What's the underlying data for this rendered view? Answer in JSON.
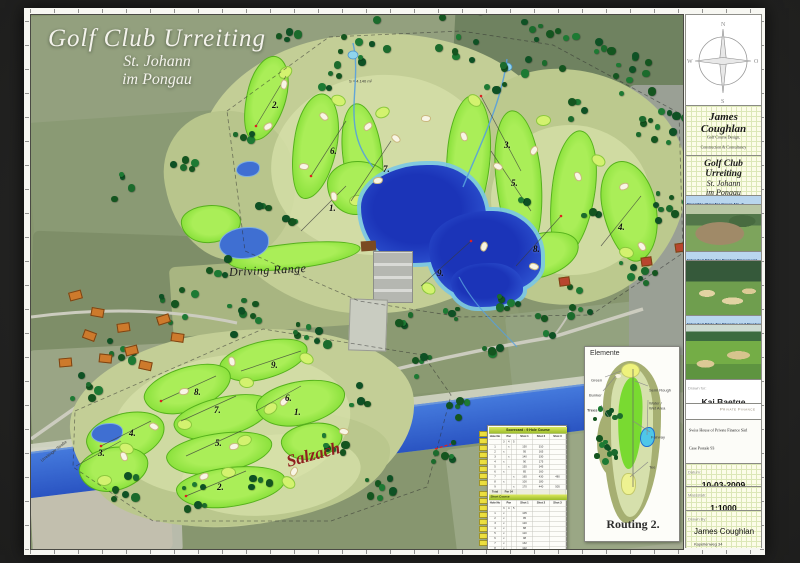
{
  "map": {
    "title_line1": "Golf Club Urreiting",
    "title_line2": "St. Johann",
    "title_line3": "im Pongau",
    "driving_range_label": "Driving Range",
    "river_label": "Salzach",
    "road_label": "Urreitinger Straße",
    "area_note": "S = 4.140 m²",
    "holes_main": [
      {
        "label": "2.",
        "x": 241,
        "y": 85
      },
      {
        "label": "6.",
        "x": 299,
        "y": 131
      },
      {
        "label": "7.",
        "x": 352,
        "y": 149
      },
      {
        "label": "3.",
        "x": 473,
        "y": 125
      },
      {
        "label": "5.",
        "x": 480,
        "y": 163
      },
      {
        "label": "1.",
        "x": 298,
        "y": 188
      },
      {
        "label": "4.",
        "x": 587,
        "y": 207
      },
      {
        "label": "8.",
        "x": 502,
        "y": 229
      },
      {
        "label": "9.",
        "x": 406,
        "y": 253
      }
    ],
    "holes_short": [
      {
        "label": "9.",
        "x": 240,
        "y": 345
      },
      {
        "label": "8.",
        "x": 163,
        "y": 372
      },
      {
        "label": "7.",
        "x": 183,
        "y": 390
      },
      {
        "label": "6.",
        "x": 254,
        "y": 378
      },
      {
        "label": "1.",
        "x": 263,
        "y": 392
      },
      {
        "label": "4.",
        "x": 98,
        "y": 413
      },
      {
        "label": "5.",
        "x": 184,
        "y": 423
      },
      {
        "label": "3.",
        "x": 67,
        "y": 433
      },
      {
        "label": "2.",
        "x": 186,
        "y": 467
      }
    ]
  },
  "elemente": {
    "title": "Elemente",
    "routing_label": "Routing 2.",
    "labels": {
      "green": "Green",
      "bunker": "Bunker",
      "trees": "Trees",
      "semi_rough": "Semi Rough",
      "water1": "Water /",
      "water2": "Wet Area",
      "fairway": "Fairway",
      "tee": "Tee"
    }
  },
  "scorecard": {
    "title": "Scorecard : 9 Hole Course",
    "col_hole": "Hole No",
    "col_par": "Par",
    "col_shot1": "Shot 1",
    "col_shot2": "Shot 2",
    "col_shot3": "Shot 3",
    "par_subcols": [
      "3",
      "4",
      "5"
    ],
    "main_rows": [
      [
        "1",
        "4",
        "150",
        "310",
        ""
      ],
      [
        "2",
        "3",
        "95",
        "165",
        ""
      ],
      [
        "3",
        "4",
        "140",
        "330",
        ""
      ],
      [
        "4",
        "3",
        "90",
        "175",
        ""
      ],
      [
        "5",
        "4",
        "155",
        "345",
        ""
      ],
      [
        "6",
        "3",
        "85",
        "160",
        ""
      ],
      [
        "7",
        "5",
        "165",
        "430",
        "480"
      ],
      [
        "8",
        "3",
        "100",
        "180",
        ""
      ],
      [
        "9",
        "5",
        "170",
        "440",
        "505"
      ]
    ],
    "total_label": "Total",
    "total_value": "Par 34",
    "short_title": "Short Course",
    "short_rows": [
      [
        "1",
        "3",
        "105"
      ],
      [
        "2",
        "3",
        "95"
      ],
      [
        "3",
        "3",
        "120"
      ],
      [
        "4",
        "3",
        "88"
      ],
      [
        "5",
        "3",
        "110"
      ],
      [
        "6",
        "3",
        "98"
      ],
      [
        "7",
        "3",
        "132"
      ],
      [
        "8",
        "3",
        "102"
      ],
      [
        "9",
        "3",
        "115"
      ]
    ],
    "short_total_label": "Total",
    "short_total_value": "Par 27"
  },
  "sidebar": {
    "compass": {
      "n": "N",
      "e": "O",
      "s": "S",
      "w": "W"
    },
    "designer": {
      "name": "James Coughlan",
      "line1": "Golf Course Design,",
      "line2": "Construction & Consultancy"
    },
    "project": {
      "line1": "Golf Club Urreiting",
      "line2": "St. Johann",
      "line3": "im Pongau"
    },
    "photos": [
      {
        "caption": "Possible View for Green No. 2"
      },
      {
        "caption": "Intended Style for Bunker Placement"
      },
      {
        "caption": "Intended Style for Shaping and Bunkering"
      }
    ],
    "drawn_for_label": "Drawn for:",
    "client_name": "Kai Baetge",
    "logo_left": "Swiss House of",
    "logo_right": "Private Finance",
    "logo_tm": "TM",
    "client_address": [
      "Swiss House of Private Finance Sàrl",
      "Case Postale 93",
      "1164 Buchillon (Switzerland)",
      "Fon +49 173 9842940",
      "Fax +41 21 807 20 11"
    ],
    "date_label": "Datum:",
    "date_value": "10-03-2009",
    "scale_label": "Massstab:",
    "scale_value": "1:1000",
    "drawnby_label": "Drawn By:",
    "drawnby_name": "James Coughlan",
    "drawnby_addr1": "Kapellenweg 34",
    "drawnby_addr2": "66606 St. Wendel",
    "drawnby_tel": "Tel:  0049-(0)162-4028521"
  }
}
